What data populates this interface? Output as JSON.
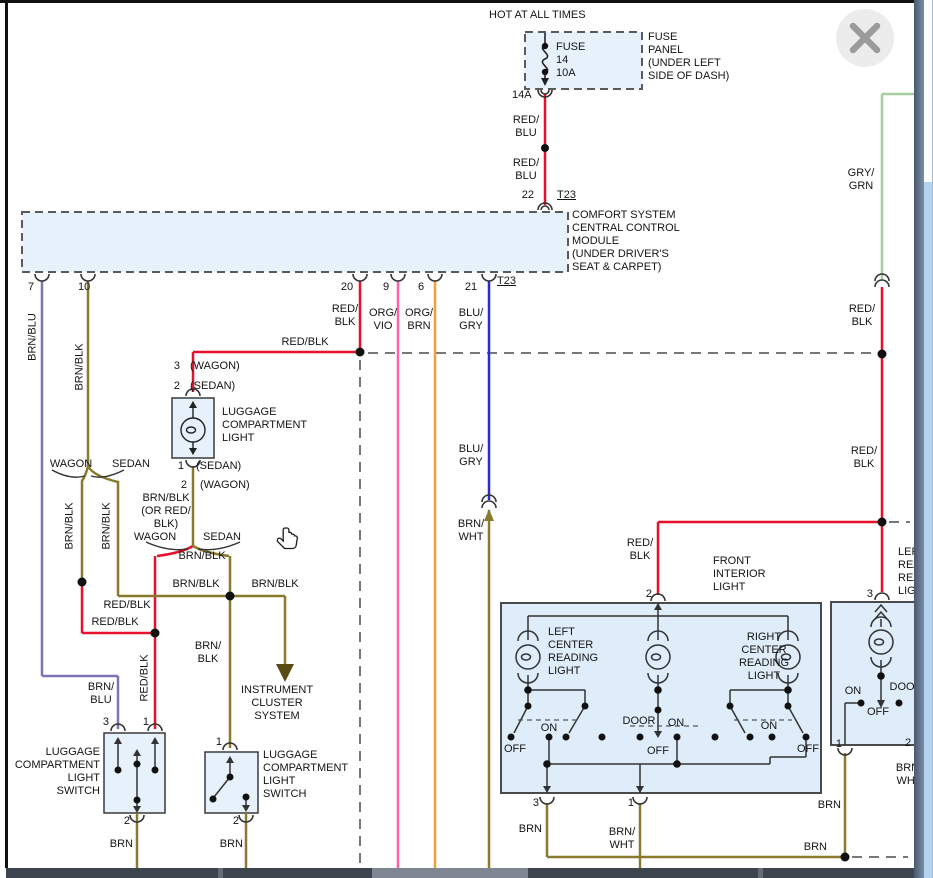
{
  "viewer": {
    "close_button": "close",
    "scrollbar": "vertical-scrollbar"
  },
  "colors": {
    "wire_red_blk": "#e8112d",
    "wire_red_blu": "#e8112d",
    "wire_brn": "#8a7a2e",
    "wire_brn_blk": "#8a7a2e",
    "wire_brn_blu": "#7f74b2",
    "wire_org_vio": "#ff62a8",
    "wire_org_brn": "#efa22f",
    "wire_blu_gry": "#2828df",
    "wire_gry_grn": "#a5cf9f",
    "dashed_wire": "#777777",
    "component_fill": "#e7f1fb",
    "instrument_arrow": "#5a4a14"
  },
  "labels": [
    {
      "n": "hot-at-all-times",
      "t": "HOT AT ALL TIMES",
      "x": 489,
      "y": 9
    },
    {
      "n": "fuse-name",
      "t": "FUSE",
      "x": 556,
      "y": 41
    },
    {
      "n": "fuse-number",
      "t": "14",
      "x": 556,
      "y": 54
    },
    {
      "n": "fuse-rating",
      "t": "10A",
      "x": 556,
      "y": 67
    },
    {
      "n": "fuse-panel-note",
      "t": "FUSE\nPANEL\n(UNDER LEFT\nSIDE OF DASH)",
      "x": 648,
      "y": 31
    },
    {
      "n": "wire-14a",
      "t": "14A",
      "x": 512,
      "y": 89
    },
    {
      "n": "red-blu-1",
      "t": "RED/\nBLU",
      "x": 526,
      "y": 114,
      "a": "c"
    },
    {
      "n": "red-blu-2",
      "t": "RED/\nBLU",
      "x": 526,
      "y": 157,
      "a": "c"
    },
    {
      "n": "pin-22",
      "t": "22",
      "x": 534,
      "y": 189,
      "a": "r"
    },
    {
      "n": "t23-top",
      "t": "T23",
      "x": 557,
      "y": 189,
      "u": 1
    },
    {
      "n": "ccm-note",
      "t": "COMFORT SYSTEM\nCENTRAL CONTROL\nMODULE\n(UNDER DRIVER'S\nSEAT & CARPET)",
      "x": 572,
      "y": 209
    },
    {
      "n": "pin-7",
      "t": "7",
      "x": 28,
      "y": 281
    },
    {
      "n": "pin-10",
      "t": "10",
      "x": 78,
      "y": 281
    },
    {
      "n": "pin-20",
      "t": "20",
      "x": 347,
      "y": 281,
      "a": "c"
    },
    {
      "n": "pin-9",
      "t": "9",
      "x": 386,
      "y": 281,
      "a": "c"
    },
    {
      "n": "pin-6",
      "t": "6",
      "x": 421,
      "y": 281,
      "a": "c"
    },
    {
      "n": "pin-21",
      "t": "21",
      "x": 471,
      "y": 281,
      "a": "c"
    },
    {
      "n": "t23-bottom",
      "t": "T23",
      "x": 497,
      "y": 275,
      "u": 1
    },
    {
      "n": "brn-blu-vert",
      "t": "BRN/BLU",
      "x": 33,
      "y": 337,
      "r": 1
    },
    {
      "n": "brn-blk-vert-1",
      "t": "BRN/BLK",
      "x": 80,
      "y": 367,
      "r": 1
    },
    {
      "n": "red-blk-pin20",
      "t": "RED/\nBLK",
      "x": 345,
      "y": 303,
      "a": "c"
    },
    {
      "n": "org-vio-lbl",
      "t": "ORG/\nVIO",
      "x": 383,
      "y": 307,
      "a": "c"
    },
    {
      "n": "org-brn-lbl",
      "t": "ORG/\nBRN",
      "x": 419,
      "y": 307,
      "a": "c"
    },
    {
      "n": "blu-gry-lbl-1",
      "t": "BLU/\nGRY",
      "x": 471,
      "y": 307,
      "a": "c"
    },
    {
      "n": "red-blk-h0",
      "t": "RED/BLK",
      "x": 305,
      "y": 336,
      "a": "c"
    },
    {
      "n": "pin-3-wagon",
      "t": "3",
      "x": 180,
      "y": 360,
      "a": "r"
    },
    {
      "n": "tag-wagon-1",
      "t": "(WAGON)",
      "x": 190,
      "y": 360
    },
    {
      "n": "pin-2-sedan",
      "t": "2",
      "x": 180,
      "y": 380,
      "a": "r"
    },
    {
      "n": "tag-sedan-1",
      "t": "(SEDAN)",
      "x": 190,
      "y": 380
    },
    {
      "n": "luggage-light-name",
      "t": "LUGGAGE\nCOMPARTMENT\nLIGHT",
      "x": 222,
      "y": 406
    },
    {
      "n": "pin-1-sedan",
      "t": "1",
      "x": 184,
      "y": 460,
      "a": "r"
    },
    {
      "n": "tag-sedan-2",
      "t": "(SEDAN)",
      "x": 196,
      "y": 460
    },
    {
      "n": "pin-2-wagon",
      "t": "2",
      "x": 187,
      "y": 479,
      "a": "r"
    },
    {
      "n": "tag-wagon-2",
      "t": "(WAGON)",
      "x": 200,
      "y": 479
    },
    {
      "n": "brn-blk-or-red",
      "t": "BRN/BLK\n(OR RED/\nBLK)",
      "x": 166,
      "y": 492,
      "a": "c"
    },
    {
      "n": "wagon-lbl-1",
      "t": "WAGON",
      "x": 71,
      "y": 458,
      "a": "c"
    },
    {
      "n": "sedan-lbl-1",
      "t": "SEDAN",
      "x": 131,
      "y": 458,
      "a": "c"
    },
    {
      "n": "brn-blk-vert-2",
      "t": "BRN/BLK",
      "x": 70,
      "y": 526,
      "r": 1
    },
    {
      "n": "brn-blk-vert-3",
      "t": "BRN/BLK",
      "x": 107,
      "y": 526,
      "r": 1
    },
    {
      "n": "wagon-lbl-2",
      "t": "WAGON",
      "x": 155,
      "y": 531,
      "a": "c"
    },
    {
      "n": "sedan-lbl-2",
      "t": "SEDAN",
      "x": 222,
      "y": 531,
      "a": "c"
    },
    {
      "n": "brn-blk-h1",
      "t": "BRN/BLK",
      "x": 202,
      "y": 550,
      "a": "c"
    },
    {
      "n": "brn-blk-h2",
      "t": "BRN/BLK",
      "x": 196,
      "y": 578,
      "a": "c"
    },
    {
      "n": "brn-blk-h3",
      "t": "BRN/BLK",
      "x": 275,
      "y": 578,
      "a": "c"
    },
    {
      "n": "red-blk-h1",
      "t": "RED/BLK",
      "x": 127,
      "y": 599,
      "a": "c"
    },
    {
      "n": "red-blk-h2",
      "t": "RED/BLK",
      "x": 115,
      "y": 616,
      "a": "c"
    },
    {
      "n": "red-blk-vert",
      "t": "RED/BLK",
      "x": 145,
      "y": 678,
      "r": 1
    },
    {
      "n": "brn-blk-2line",
      "t": "BRN/\nBLK",
      "x": 208,
      "y": 640,
      "a": "c"
    },
    {
      "n": "brn-blu-2line",
      "t": "BRN/\nBLU",
      "x": 101,
      "y": 681,
      "a": "c"
    },
    {
      "n": "instrument-cluster",
      "t": "INSTRUMENT\nCLUSTER\nSYSTEM",
      "x": 277,
      "y": 684,
      "a": "c"
    },
    {
      "n": "pin-3-sw1",
      "t": "3",
      "x": 109,
      "y": 716,
      "a": "r"
    },
    {
      "n": "pin-1-sw1",
      "t": "1",
      "x": 149,
      "y": 716,
      "a": "r"
    },
    {
      "n": "sw1-name",
      "t": "LUGGAGE\nCOMPARTMENT\nLIGHT\nSWITCH",
      "x": 100,
      "y": 746,
      "a": "r"
    },
    {
      "n": "pin-2-sw1",
      "t": "2",
      "x": 130,
      "y": 815,
      "a": "r"
    },
    {
      "n": "brn-sw1",
      "t": "BRN",
      "x": 133,
      "y": 838,
      "a": "r"
    },
    {
      "n": "pin-1-sw2",
      "t": "1",
      "x": 222,
      "y": 736,
      "a": "r"
    },
    {
      "n": "sw2-name",
      "t": "LUGGAGE\nCOMPARTMENT\nLIGHT\nSWITCH",
      "x": 263,
      "y": 749
    },
    {
      "n": "pin-2-sw2",
      "t": "2",
      "x": 239,
      "y": 815,
      "a": "r"
    },
    {
      "n": "brn-sw2",
      "t": "BRN",
      "x": 243,
      "y": 838,
      "a": "r"
    },
    {
      "n": "blu-gry-lbl-2",
      "t": "BLU/\nGRY",
      "x": 471,
      "y": 443,
      "a": "c"
    },
    {
      "n": "brn-wht-1",
      "t": "BRN/\nWHT",
      "x": 471,
      "y": 518,
      "a": "c"
    },
    {
      "n": "gry-grn-lbl",
      "t": "GRY/\nGRN",
      "x": 861,
      "y": 167,
      "a": "c"
    },
    {
      "n": "red-blk-r1",
      "t": "RED/\nBLK",
      "x": 862,
      "y": 303,
      "a": "c"
    },
    {
      "n": "red-blk-r2",
      "t": "RED/\nBLK",
      "x": 864,
      "y": 445,
      "a": "c"
    },
    {
      "n": "red-blk-front",
      "t": "RED/\nBLK",
      "x": 640,
      "y": 537,
      "a": "c"
    },
    {
      "n": "front-light-name",
      "t": "FRONT\nINTERIOR\nLIGHT",
      "x": 713,
      "y": 555
    },
    {
      "n": "pin-2-front",
      "t": "2",
      "x": 652,
      "y": 588,
      "a": "r"
    },
    {
      "n": "pin-3-right",
      "t": "3",
      "x": 873,
      "y": 588,
      "a": "r"
    },
    {
      "n": "left-rear-name",
      "t": "LEFT\nREAR\nREADING\nLIGHT",
      "x": 898,
      "y": 546
    },
    {
      "n": "left-center-name",
      "t": "LEFT\nCENTER\nREADING\nLIGHT",
      "x": 548,
      "y": 626
    },
    {
      "n": "right-center-name",
      "t": "RIGHT\nCENTER\nREADING\nLIGHT",
      "x": 764,
      "y": 631,
      "a": "c"
    },
    {
      "n": "off-1",
      "t": "OFF",
      "x": 504,
      "y": 743
    },
    {
      "n": "on-1",
      "t": "ON",
      "x": 549,
      "y": 722,
      "a": "c"
    },
    {
      "n": "door-1",
      "t": "DOOR",
      "x": 639,
      "y": 715,
      "a": "c"
    },
    {
      "n": "on-2",
      "t": "ON",
      "x": 676,
      "y": 717,
      "a": "c"
    },
    {
      "n": "off-2",
      "t": "OFF",
      "x": 658,
      "y": 745,
      "a": "c"
    },
    {
      "n": "on-3",
      "t": "ON",
      "x": 769,
      "y": 720,
      "a": "c"
    },
    {
      "n": "off-3",
      "t": "OFF",
      "x": 808,
      "y": 743,
      "a": "c"
    },
    {
      "n": "pin-3-front",
      "t": "3",
      "x": 539,
      "y": 797,
      "a": "r"
    },
    {
      "n": "pin-1-front",
      "t": "1",
      "x": 634,
      "y": 797,
      "a": "r"
    },
    {
      "n": "brn-front",
      "t": "BRN",
      "x": 542,
      "y": 823,
      "a": "r"
    },
    {
      "n": "brn-wht-2",
      "t": "BRN/\nWHT",
      "x": 622,
      "y": 826,
      "a": "c"
    },
    {
      "n": "on-right-box",
      "t": "ON",
      "x": 853,
      "y": 685,
      "a": "c"
    },
    {
      "n": "door-right-box",
      "t": "DOOR",
      "x": 906,
      "y": 681,
      "a": "c"
    },
    {
      "n": "off-right-box",
      "t": "OFF",
      "x": 878,
      "y": 706,
      "a": "c"
    },
    {
      "n": "pin-1-right",
      "t": "1",
      "x": 842,
      "y": 738,
      "a": "r"
    },
    {
      "n": "pin-2-right",
      "t": "2",
      "x": 908,
      "y": 737,
      "a": "c"
    },
    {
      "n": "brn-wht-right",
      "t": "BRN/\nWHT",
      "x": 909,
      "y": 762,
      "a": "c"
    },
    {
      "n": "brn-right-1",
      "t": "BRN",
      "x": 841,
      "y": 799,
      "a": "r"
    },
    {
      "n": "brn-right-2",
      "t": "BRN",
      "x": 827,
      "y": 841,
      "a": "r"
    }
  ]
}
